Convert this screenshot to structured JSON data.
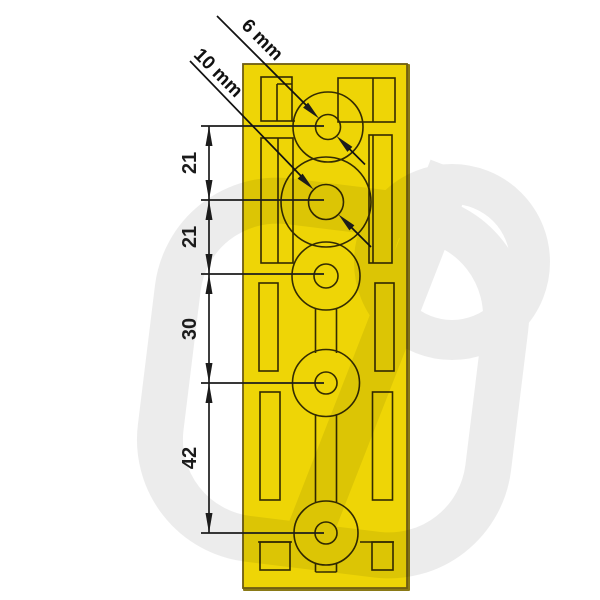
{
  "drawing": {
    "description": "Technical dimension drawing of a yellow die-cut membrane cable-entry plate with five circular grommet hubs",
    "colors": {
      "background": "#ffffff",
      "plate_face": "#eed506",
      "plate_edge": "#8a7a16",
      "plate_outline": "#6e5d12",
      "cut_lines": "#332b02",
      "dimension_lines": "#1c1c1c",
      "watermark": "#000000"
    },
    "leader_labels": {
      "small_hole": "6 mm",
      "large_hole": "10 mm"
    },
    "dimension_chain": {
      "orientation": "vertical",
      "labels": [
        "21",
        "21",
        "30",
        "42"
      ]
    }
  }
}
